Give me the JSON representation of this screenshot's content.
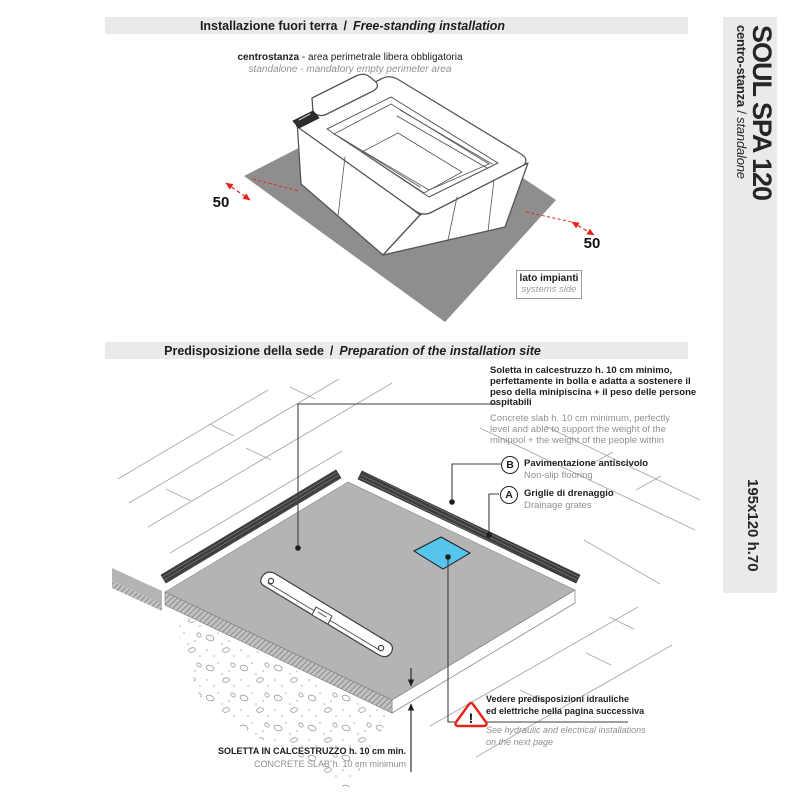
{
  "colors": {
    "band_gray": "#e9eaec",
    "perimeter_gray": "#8e8e8e",
    "slab_gray": "#b4b4b4",
    "accent_red": "#e5231b",
    "hydraulic_blue": "#56c5ee"
  },
  "sections": {
    "top": {
      "band": {
        "it": "Installazione fuori terra",
        "sep": "/",
        "en": "Free-standing installation"
      },
      "caption": {
        "it_bold": "centrostanza",
        "it_rest": " - area perimetrale libera obbligatoria",
        "en": "standalone - mandatory empty perimeter area"
      },
      "dim_left": "50",
      "dim_right": "50",
      "systems_side": {
        "it": "lato impianti",
        "en": "systems side"
      }
    },
    "bottom": {
      "band": {
        "it": "Predisposizione della sede",
        "sep": "/",
        "en": "Preparation of the installation site"
      },
      "slab_note": {
        "it_lines": [
          "Soletta in calcestruzzo h. 10 cm minimo,",
          "perfettamente in bolla e adatta a sostenere il",
          "peso della minipiscina + il peso delle persone",
          "ospitabili"
        ],
        "en_lines": [
          "Concrete slab h. 10 cm minimum, perfectly",
          "level and able to support the weight of the",
          "minipool + the weight of the people within"
        ]
      },
      "legend_b": {
        "letter": "B",
        "it": "Pavimentazione antiscivolo",
        "en": "Non-slip flooring"
      },
      "legend_a": {
        "letter": "A",
        "it": "Griglie di drenaggio",
        "en": "Drainage grates"
      },
      "warning": {
        "symbol": "!",
        "it_lines": [
          "Vedere predisposizioni idrauliche",
          "ed elettriche nella pagina successiva"
        ],
        "en_lines": [
          "See hydraulic and electrical installations",
          "on the next page"
        ]
      },
      "slab_caption": {
        "it": "SOLETTA IN CALCESTRUZZO  h. 10 cm min.",
        "en": "CONCRETE SLAB  h. 10 cm minimum"
      }
    }
  },
  "sidebar": {
    "title": "SOUL SPA 120",
    "subtitle_it": "centro-stanza",
    "subtitle_sep": " / ",
    "subtitle_en": "standalone",
    "dimensions": "195x120 h.70"
  }
}
